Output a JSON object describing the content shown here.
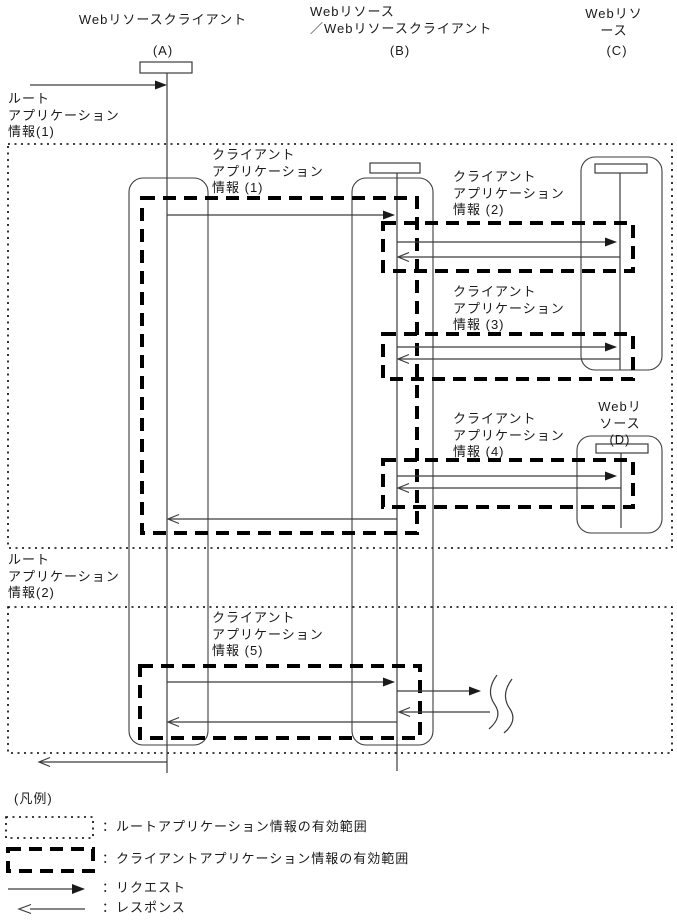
{
  "page": {
    "width": 677,
    "height": 921,
    "background": "#ffffff"
  },
  "colors": {
    "thin_line": "#3c3c3c",
    "scope_line": "#000000",
    "text": "#1a1a1a"
  },
  "columns": {
    "a": {
      "title": "Webリソースクライアント",
      "id": "(A)"
    },
    "b": {
      "title": "Webリソース\n／Webリソースクライアント",
      "id": "(B)"
    },
    "c": {
      "title": "Webリソース",
      "id": "(C)"
    },
    "d": {
      "title": "Webリソース\n(D)"
    }
  },
  "scopes": {
    "root1": "ルート\nアプリケーション\n情報(1)",
    "root2": "ルート\nアプリケーション\n情報(2)",
    "client1": "クライアント\nアプリケーション\n情報 (1)",
    "client2": "クライアント\nアプリケーション\n情報 (2)",
    "client3": "クライアント\nアプリケーション\n情報 (3)",
    "client4": "クライアント\nアプリケーション\n情報 (4)",
    "client5": "クライアント\nアプリケーション\n情報 (5)"
  },
  "legend": {
    "title": "(凡例)",
    "items": [
      {
        "symbol": "dotted-box",
        "label": "：ルートアプリケーション情報の有効範囲"
      },
      {
        "symbol": "dashed-box",
        "label": "：クライアントアプリケーション情報の有効範囲"
      },
      {
        "symbol": "request-arrow",
        "label": "：リクエスト"
      },
      {
        "symbol": "response-arrow",
        "label": "：レスポンス"
      }
    ]
  }
}
